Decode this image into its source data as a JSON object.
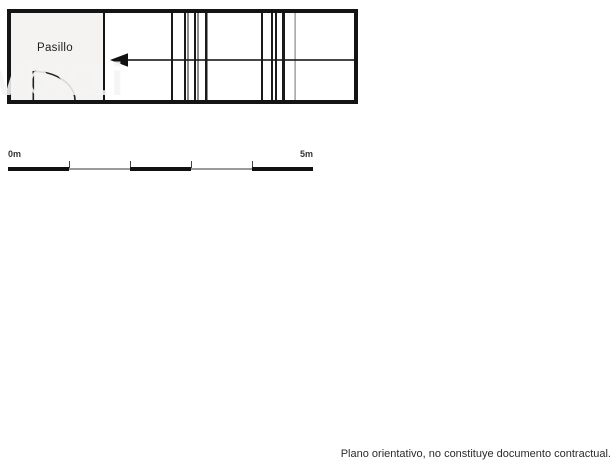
{
  "plan": {
    "room_label": "Pasillo"
  },
  "scale_bar": {
    "start_label": "0m",
    "end_label": "5m"
  },
  "watermark_text": "vbx1i",
  "disclaimer_text": "Plano orientativo, no constituye documento contractual.",
  "colors": {
    "background": "#ffffff",
    "plan_line": "#141414",
    "room_fill": "#f4f3f2",
    "scale_gray": "#9a9a9a",
    "text": "#2b2b2b"
  }
}
